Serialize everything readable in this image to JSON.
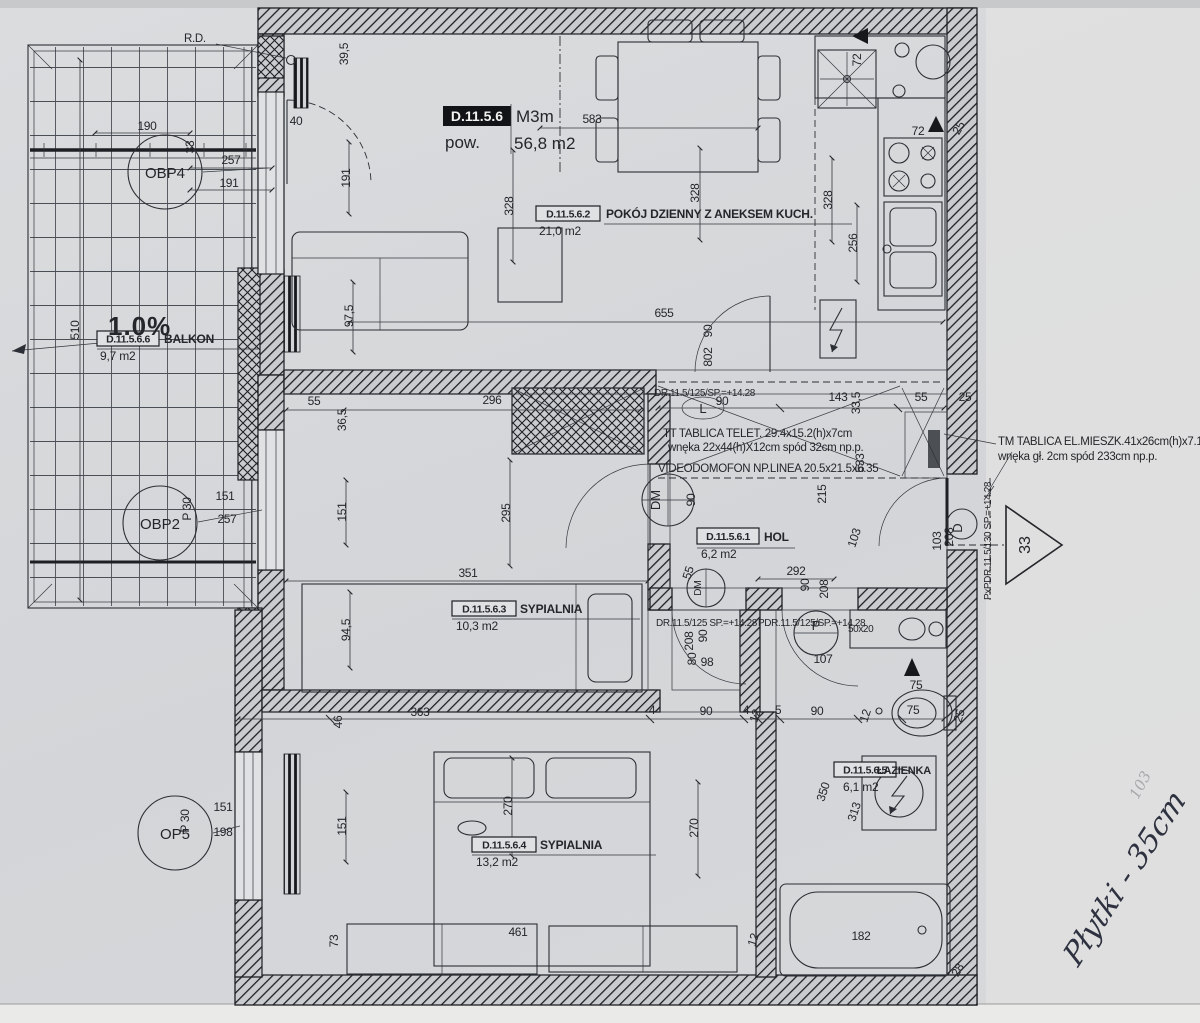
{
  "title_block": {
    "code": "D.11.5.6",
    "type": "M3m",
    "area_label": "pow.",
    "area": "56,8 m2"
  },
  "rooms": {
    "living": {
      "code": "D.11.5.6.2",
      "name": "POKÓJ DZIENNY Z ANEKSEM KUCH.",
      "area": "21,0 m2"
    },
    "hol": {
      "code": "D.11.5.6.1",
      "name": "HOL",
      "area": "6,2 m2"
    },
    "bedroom1": {
      "code": "D.11.5.6.3",
      "name": "SYPIALNIA",
      "area": "10,3 m2"
    },
    "bedroom2": {
      "code": "D.11.5.6.4",
      "name": "SYPIALNIA",
      "area": "13,2 m2"
    },
    "bathroom": {
      "code": "D.11.5.6.5",
      "name": "ŁAZIENKA",
      "area": "6,1 m2"
    },
    "balcony": {
      "code": "D.11.5.6.6",
      "name": "BALKON",
      "area": "9,7 m2"
    }
  },
  "annotations": {
    "rd": "R.D.",
    "slope": "1.0%",
    "tt1": "TT TABLICA TELET. 29.4x15.2(h)x7cm",
    "tt2": "wnęka 22x44(h)X12cm spód 32cm np.p.",
    "video": "VIDEODOMOFON NP.LINEA 20.5x21.5x6.35",
    "dr_top": "DR.11.5/125/SP.=+14.28",
    "dr_mid1": "DR.11.5/125 SP.=+14.28",
    "dr_mid2": "PDR.11.5/125/SP.=+14.28",
    "pdr_right": "PxPDR.11.5/130 SP.=+14.28",
    "tm1": "TM TABLICA EL.MIESZK.41x26cm(h)x7.1cm",
    "tm2": "wnęka gł. 2cm spód 233cm np.p.",
    "niche": "50x20"
  },
  "markers": {
    "obp4": "OBP4",
    "obp2": "OBP2",
    "op5": "OP5",
    "dm1": "DM",
    "dm2": "DM",
    "p": "P",
    "l": "L",
    "d": "D",
    "triangle": "33"
  },
  "handwriting": {
    "note": "Płytki - 35cm",
    "faint": "103"
  },
  "dimensions": [
    {
      "t": "190",
      "x": 147,
      "y": 130
    },
    {
      "t": "33",
      "x": 194,
      "y": 147,
      "r": -90
    },
    {
      "t": "257",
      "x": 231,
      "y": 164
    },
    {
      "t": "191",
      "x": 229,
      "y": 187
    },
    {
      "t": "40",
      "x": 296,
      "y": 125
    },
    {
      "t": "39,5",
      "x": 348,
      "y": 54,
      "r": -90
    },
    {
      "t": "191",
      "x": 350,
      "y": 178,
      "r": -90
    },
    {
      "t": "97,5",
      "x": 353,
      "y": 316,
      "r": -90
    },
    {
      "t": "583",
      "x": 592,
      "y": 123
    },
    {
      "t": "328",
      "x": 513,
      "y": 206,
      "r": -90
    },
    {
      "t": "328",
      "x": 699,
      "y": 193,
      "r": -90
    },
    {
      "t": "328",
      "x": 832,
      "y": 200,
      "r": -90
    },
    {
      "t": "256",
      "x": 857,
      "y": 243,
      "r": -90
    },
    {
      "t": "72",
      "x": 861,
      "y": 60,
      "r": -90
    },
    {
      "t": "72",
      "x": 918,
      "y": 135
    },
    {
      "t": "25",
      "x": 962,
      "y": 130,
      "r": -60
    },
    {
      "t": "655",
      "x": 664,
      "y": 317
    },
    {
      "t": "55",
      "x": 314,
      "y": 405
    },
    {
      "t": "36,5",
      "x": 346,
      "y": 420,
      "r": -90
    },
    {
      "t": "296",
      "x": 492,
      "y": 404
    },
    {
      "t": "90",
      "x": 722,
      "y": 405
    },
    {
      "t": "143",
      "x": 838,
      "y": 401
    },
    {
      "t": "55",
      "x": 921,
      "y": 401
    },
    {
      "t": "25",
      "x": 965,
      "y": 401
    },
    {
      "t": "33,5",
      "x": 860,
      "y": 403,
      "r": -90
    },
    {
      "t": "533",
      "x": 864,
      "y": 463,
      "r": -90
    },
    {
      "t": "295",
      "x": 510,
      "y": 513,
      "r": -90
    },
    {
      "t": "90",
      "x": 712,
      "y": 331,
      "r": -90
    },
    {
      "t": "802",
      "x": 712,
      "y": 357,
      "r": -90
    },
    {
      "t": "90",
      "x": 695,
      "y": 500,
      "r": -90
    },
    {
      "t": "151",
      "x": 225,
      "y": 500
    },
    {
      "t": "257",
      "x": 227,
      "y": 523
    },
    {
      "t": "P 30",
      "x": 191,
      "y": 509,
      "r": -90
    },
    {
      "t": "151",
      "x": 346,
      "y": 512,
      "r": -90
    },
    {
      "t": "215",
      "x": 826,
      "y": 494,
      "r": -90
    },
    {
      "t": "103",
      "x": 858,
      "y": 539,
      "r": -72
    },
    {
      "t": "292",
      "x": 796,
      "y": 575
    },
    {
      "t": "90",
      "x": 809,
      "y": 585,
      "r": -90
    },
    {
      "t": "208",
      "x": 828,
      "y": 589,
      "r": -90
    },
    {
      "t": "103",
      "x": 941,
      "y": 541,
      "r": -90
    },
    {
      "t": "208",
      "x": 953,
      "y": 537,
      "r": -90
    },
    {
      "t": "55",
      "x": 692,
      "y": 574,
      "r": -72
    },
    {
      "t": "351",
      "x": 468,
      "y": 577
    },
    {
      "t": "94,5",
      "x": 350,
      "y": 630,
      "r": -90
    },
    {
      "t": "208",
      "x": 693,
      "y": 641,
      "r": -90
    },
    {
      "t": "90",
      "x": 707,
      "y": 636,
      "r": -90
    },
    {
      "t": "80",
      "x": 696,
      "y": 659,
      "r": -90
    },
    {
      "t": "98",
      "x": 707,
      "y": 666
    },
    {
      "t": "107",
      "x": 823,
      "y": 663
    },
    {
      "t": "363",
      "x": 420,
      "y": 716
    },
    {
      "t": "46",
      "x": 342,
      "y": 722,
      "r": -90
    },
    {
      "t": "4",
      "x": 652,
      "y": 714
    },
    {
      "t": "90",
      "x": 706,
      "y": 715
    },
    {
      "t": "4",
      "x": 746,
      "y": 714
    },
    {
      "t": "12",
      "x": 759,
      "y": 717,
      "r": -72
    },
    {
      "t": "5",
      "x": 778,
      "y": 714
    },
    {
      "t": "90",
      "x": 817,
      "y": 715
    },
    {
      "t": "12",
      "x": 869,
      "y": 717,
      "r": -72
    },
    {
      "t": "75",
      "x": 913,
      "y": 714
    },
    {
      "t": "25",
      "x": 963,
      "y": 717,
      "r": -72
    },
    {
      "t": "75",
      "x": 916,
      "y": 689
    },
    {
      "t": "350",
      "x": 827,
      "y": 793,
      "r": -72
    },
    {
      "t": "313",
      "x": 858,
      "y": 813,
      "r": -72
    },
    {
      "t": "270",
      "x": 512,
      "y": 806,
      "r": -90
    },
    {
      "t": "270",
      "x": 698,
      "y": 828,
      "r": -90
    },
    {
      "t": "73",
      "x": 338,
      "y": 941,
      "r": -90
    },
    {
      "t": "461",
      "x": 518,
      "y": 936
    },
    {
      "t": "12",
      "x": 757,
      "y": 941,
      "r": -72
    },
    {
      "t": "182",
      "x": 861,
      "y": 940
    },
    {
      "t": "28",
      "x": 961,
      "y": 972,
      "r": -60
    },
    {
      "t": "510",
      "x": 79,
      "y": 330,
      "r": -90
    },
    {
      "t": "151",
      "x": 223,
      "y": 811
    },
    {
      "t": "198",
      "x": 223,
      "y": 836
    },
    {
      "t": "P 30",
      "x": 189,
      "y": 821,
      "r": -90
    },
    {
      "t": "151",
      "x": 346,
      "y": 826,
      "r": -90
    }
  ]
}
